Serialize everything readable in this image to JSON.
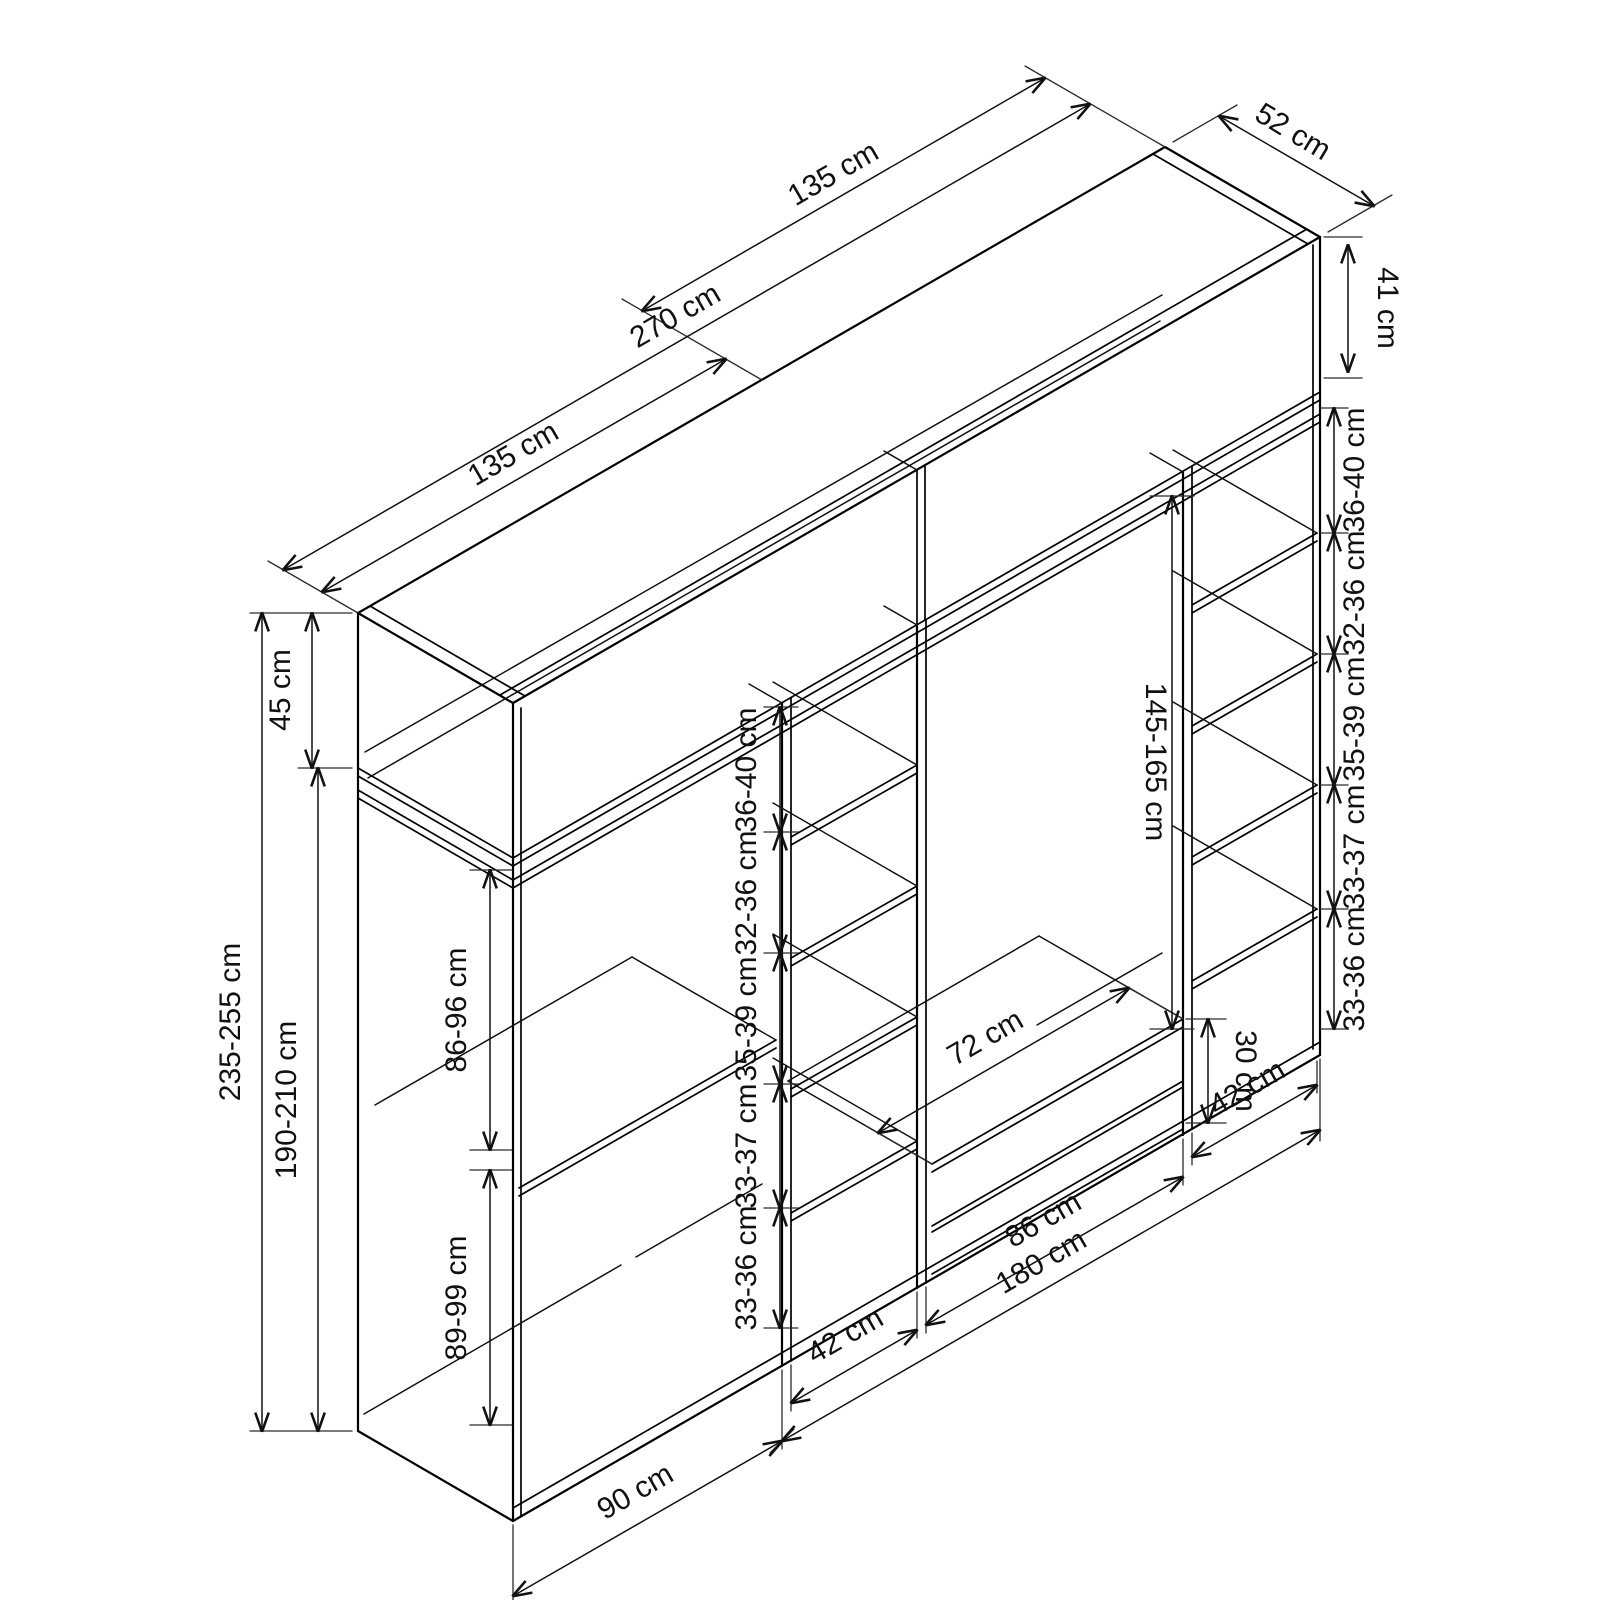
{
  "diagram": {
    "title": "wardrobe-dimension-diagram",
    "unit": "cm",
    "dimensions": {
      "top_left_half": "135 cm",
      "top_total": "270 cm",
      "top_right_half": "135 cm",
      "depth": "52 cm",
      "upper_right_height": "41 cm",
      "upper_left_height": "45 cm",
      "total_height": "235-255 cm",
      "body_height": "190-210 cm",
      "left_upper_space": "86-96 cm",
      "left_lower_space": "89-99 cm",
      "hanging_space": "145-165 cm",
      "drawer_top_width": "72 cm",
      "drawer_stack_height": "30 cm",
      "middle_shelf_spaces": [
        "36-40 cm",
        "32-36 cm",
        "35-39 cm",
        "33-37 cm",
        "33-36 cm"
      ],
      "right_shelf_spaces": [
        "36-40 cm",
        "32-36 cm",
        "35-39 cm",
        "33-37 cm",
        "33-36 cm"
      ],
      "bottom_left_module": "90 cm",
      "bottom_left_column": "42 cm",
      "bottom_center_module": "86 cm",
      "bottom_right_column": "42 cm",
      "bottom_right_group": "180 cm"
    }
  }
}
